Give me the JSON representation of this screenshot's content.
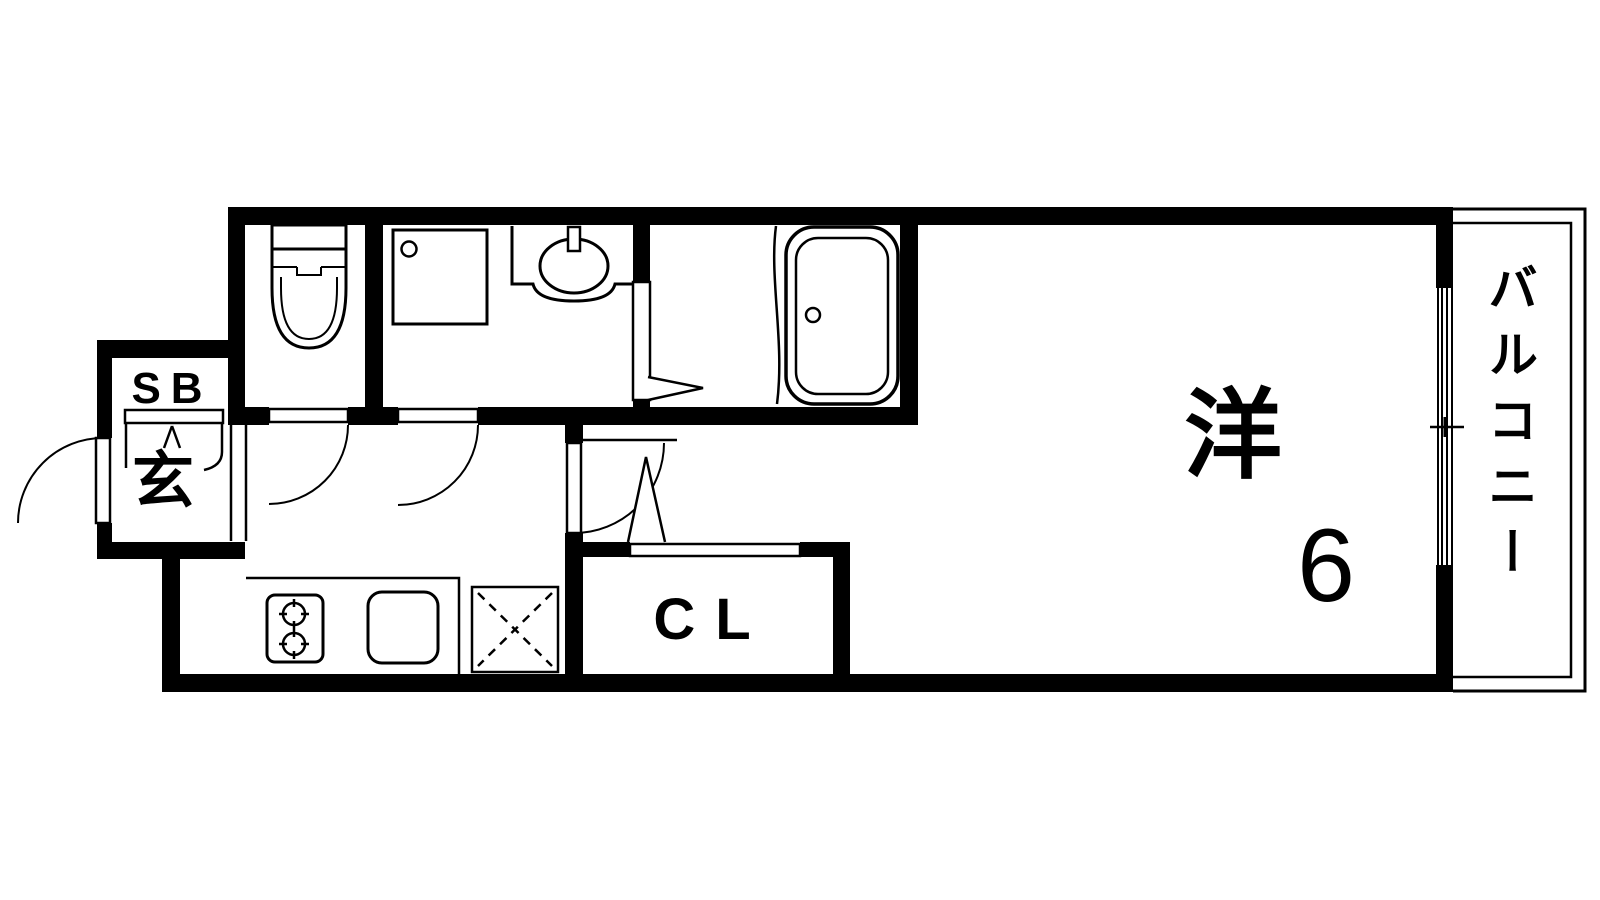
{
  "floorplan": {
    "type": "apartment-floor-plan",
    "colors": {
      "line": "#000000",
      "background": "#ffffff"
    },
    "labels": {
      "shoe_box": "SB",
      "entrance": "玄",
      "closet": "CL",
      "western_room": "洋",
      "western_room_size": "6",
      "balcony": "バルコニー"
    },
    "icons": [
      "toilet-icon",
      "washer-pan-icon",
      "wash-basin-icon",
      "bathtub-icon",
      "stove-icon",
      "kitchen-sink-icon",
      "refrigerator-space-icon",
      "entrance-door-icon",
      "toilet-door-icon",
      "washroom-door-icon",
      "room-door-icon",
      "closet-folding-door-icon",
      "bath-folding-door-icon",
      "window-icon",
      "balcony-railing-icon",
      "entrance-step-icon"
    ]
  }
}
